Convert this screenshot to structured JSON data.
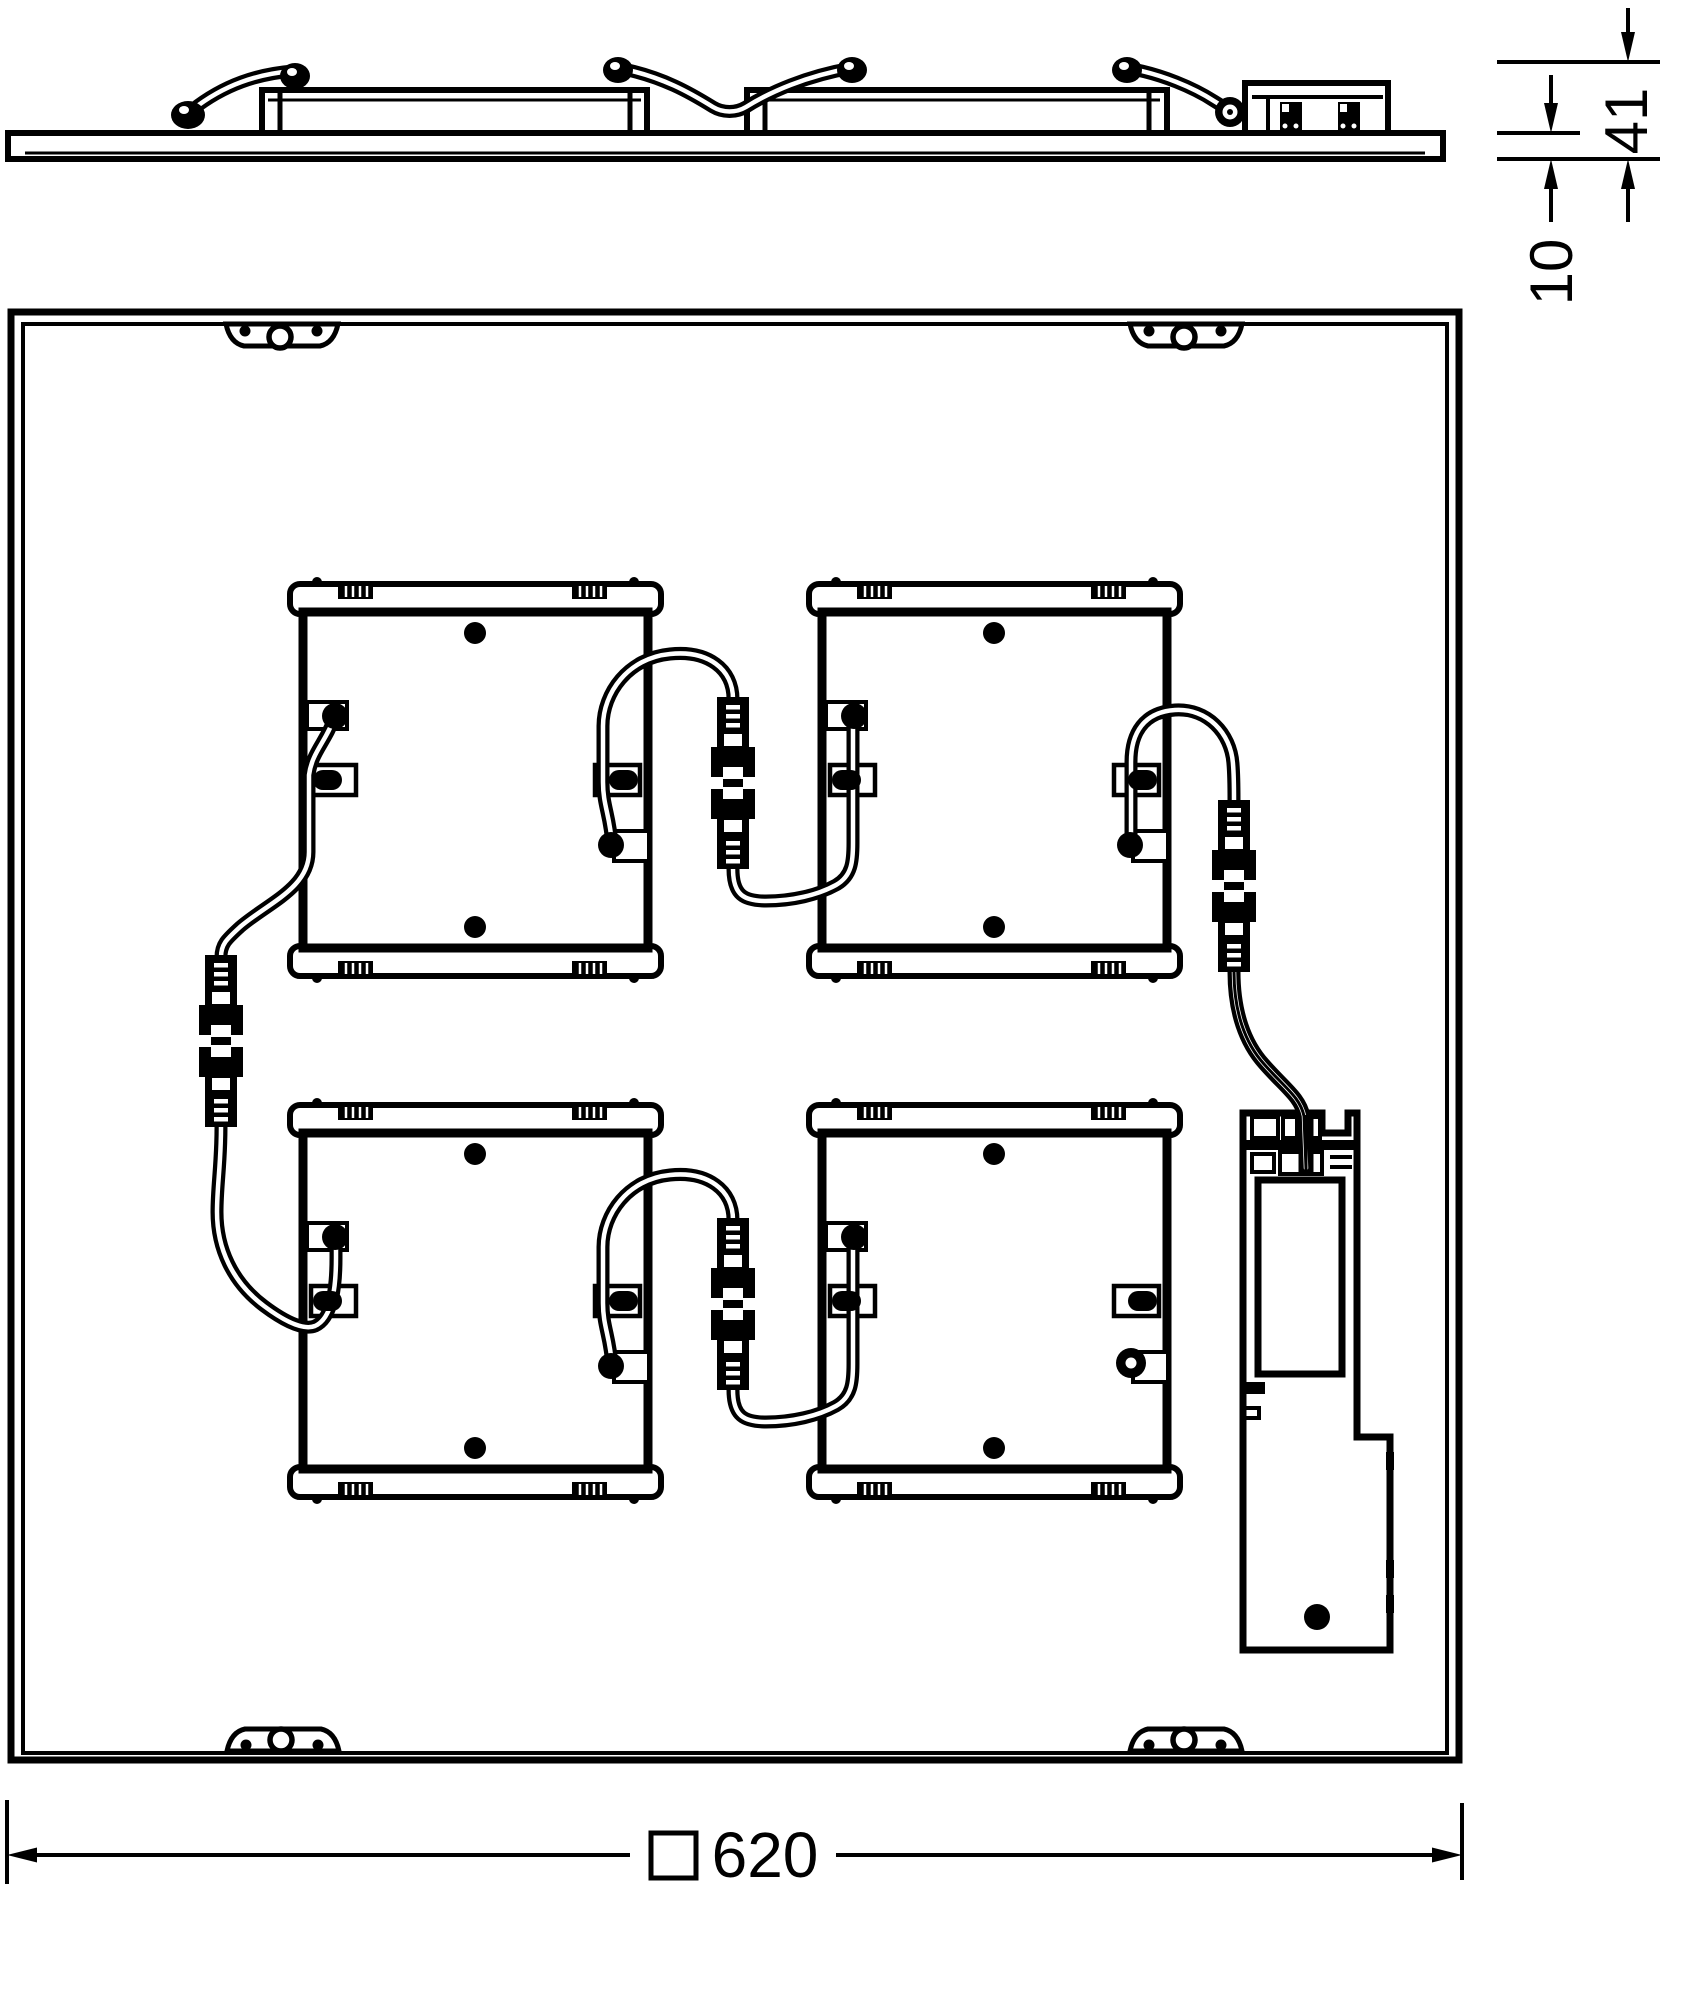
{
  "drawing": {
    "type": "technical-dimension-drawing",
    "description": "Square LED panel luminaire shown as side profile (top) and rear plan view (bottom) with four LED modules, plug-in cable connectors, mounting brackets and a driver unit",
    "background_color": "#ffffff",
    "line_color": "#000000",
    "dimensions": {
      "overall_height_mm": "41",
      "panel_thickness_mm": "10",
      "panel_size_symbol": "□",
      "panel_size_mm": "620"
    },
    "parts": {
      "led_module_count": 4,
      "inline_connector_count": 4,
      "mounting_bracket_count": 4,
      "driver_count": 1,
      "screw_dot_per_module": 2
    }
  }
}
